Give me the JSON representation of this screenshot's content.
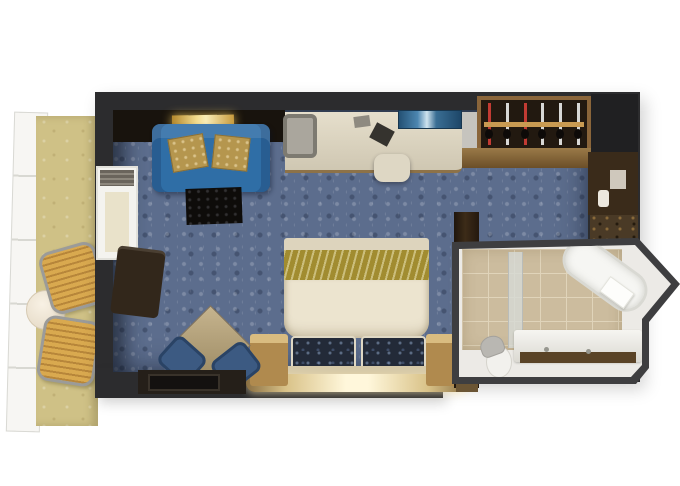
{
  "meta": {
    "title": "Balcony stateroom floor plan (top-down 3D render)",
    "canvas": {
      "width": 680,
      "height": 486
    }
  },
  "colors": {
    "background": "#ffffff",
    "wall": "#2c2c2e",
    "wallDark": "#202022",
    "carpet": "#5c6d8d",
    "balconyFloor": "#cfc186",
    "railing": "#f7f6f3",
    "chairWicker": "#d9a94f",
    "chairFrame": "#9b9b99",
    "sofa": "#2f6ea6",
    "sofaPillow": "#b5964e",
    "deskChair": "#aaa69d",
    "closetWood": "#8a653a",
    "closetInterior": "#221910",
    "closetRail": "#c89a52",
    "hangerRed": "#c23b33",
    "hangerSilver": "#d8d8d6",
    "entryBrown": "#3a2b1a",
    "entryMat": "#4a3a26",
    "doorPlate": "#cfc8bc",
    "bedRunner": "#a18c30",
    "bedDuvet": "#ece4cf",
    "bedFoot": "#ddd4bd",
    "pillowNavy": "#232a38",
    "headboard": "#d6c9a8",
    "ledgeGlow": "#fff7db",
    "ledgeWood": "#8a6f42",
    "nightstand": "#b08a4e",
    "nightstandTop": "#d9bc80",
    "sideTable": "#b3a27c",
    "diningChairBlue": "#3c5a82",
    "bench": "#251f19",
    "rug": "#0e0c0a",
    "armchairBrown": "#32271b",
    "wallLightAmber": "#ff9d2e",
    "bathWall": "#eceae6",
    "bathBorder": "#3e3e40",
    "bathTile": "#ccbc9e",
    "tileGrout": "#e0d4ba",
    "tub": "#f6f6f3",
    "vanityWood": "#5a4326",
    "toiletLid": "#b9b7b2"
  },
  "closet": {
    "hangers": [
      "red",
      "silver",
      "red",
      "silver",
      "silver",
      "silver"
    ]
  },
  "rooms": {
    "balcony": {
      "label": "balcony",
      "furniture": [
        "railing",
        "lounge chair",
        "lounge chair",
        "round side table"
      ]
    },
    "bedroom": {
      "label": "stateroom",
      "furniture": [
        "sofa with two gold pillows",
        "lit console shelf",
        "desk",
        "desk chair",
        "desk stool",
        "glass shelf",
        "minibar",
        "wardrobe with hangers",
        "double bed with runner and two navy pillows",
        "nightstand left",
        "nightstand right",
        "lit headboard ledge",
        "diamond side table",
        "two blue chairs",
        "bench",
        "dark rug",
        "dark armchair",
        "balcony door"
      ]
    },
    "entry": {
      "label": "entry",
      "furniture": [
        "cabin door",
        "door plate",
        "door handle",
        "entry mat",
        "tall cabinet"
      ]
    },
    "bathroom": {
      "label": "bathroom",
      "furniture": [
        "angled bathtub",
        "towel",
        "vanity counter",
        "two faucets",
        "toilet",
        "shower glass panel",
        "beige tile floor"
      ]
    }
  }
}
